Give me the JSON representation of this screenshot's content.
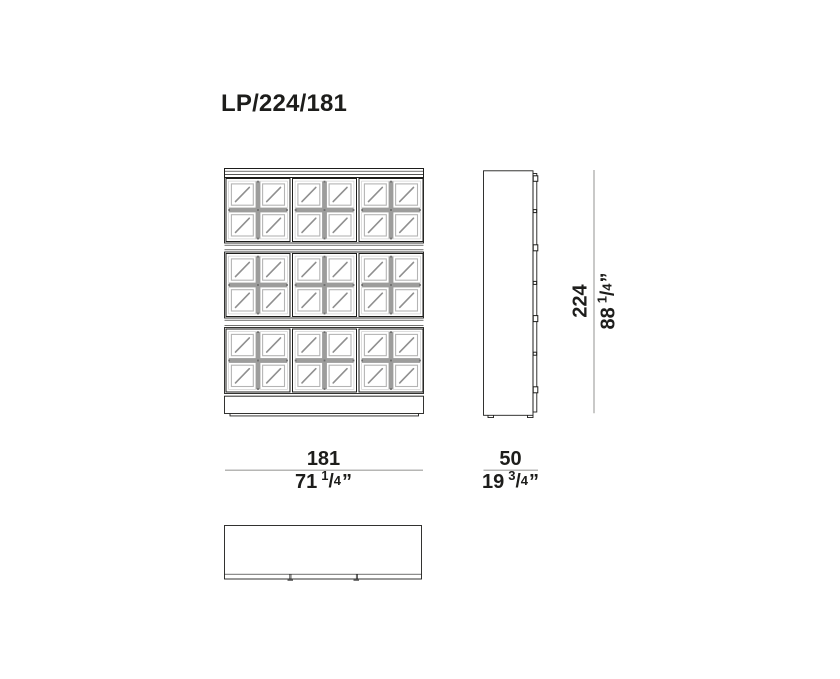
{
  "title": "LP/224/181",
  "colors": {
    "ink": "#1d1d1b",
    "gray_line": "#9d9d9c",
    "muntin": "#9d9d9c",
    "glass_stroke": "#b4b4b4",
    "hatch": "#8f8f8f",
    "dim_line": "#9d9d9c",
    "background": "#ffffff"
  },
  "dimensions": {
    "height": {
      "cm": "224",
      "in_whole": "88",
      "frac_num": "1",
      "frac_slash": "/",
      "frac_den": "4",
      "unit": "”"
    },
    "width": {
      "cm": "181",
      "in_whole": "71",
      "frac_num": "1",
      "frac_slash": "/",
      "frac_den": "4",
      "unit": "”"
    },
    "depth": {
      "cm": "50",
      "in_whole": "19",
      "frac_num": "3",
      "frac_slash": "/",
      "frac_den": "4",
      "unit": "”"
    }
  }
}
